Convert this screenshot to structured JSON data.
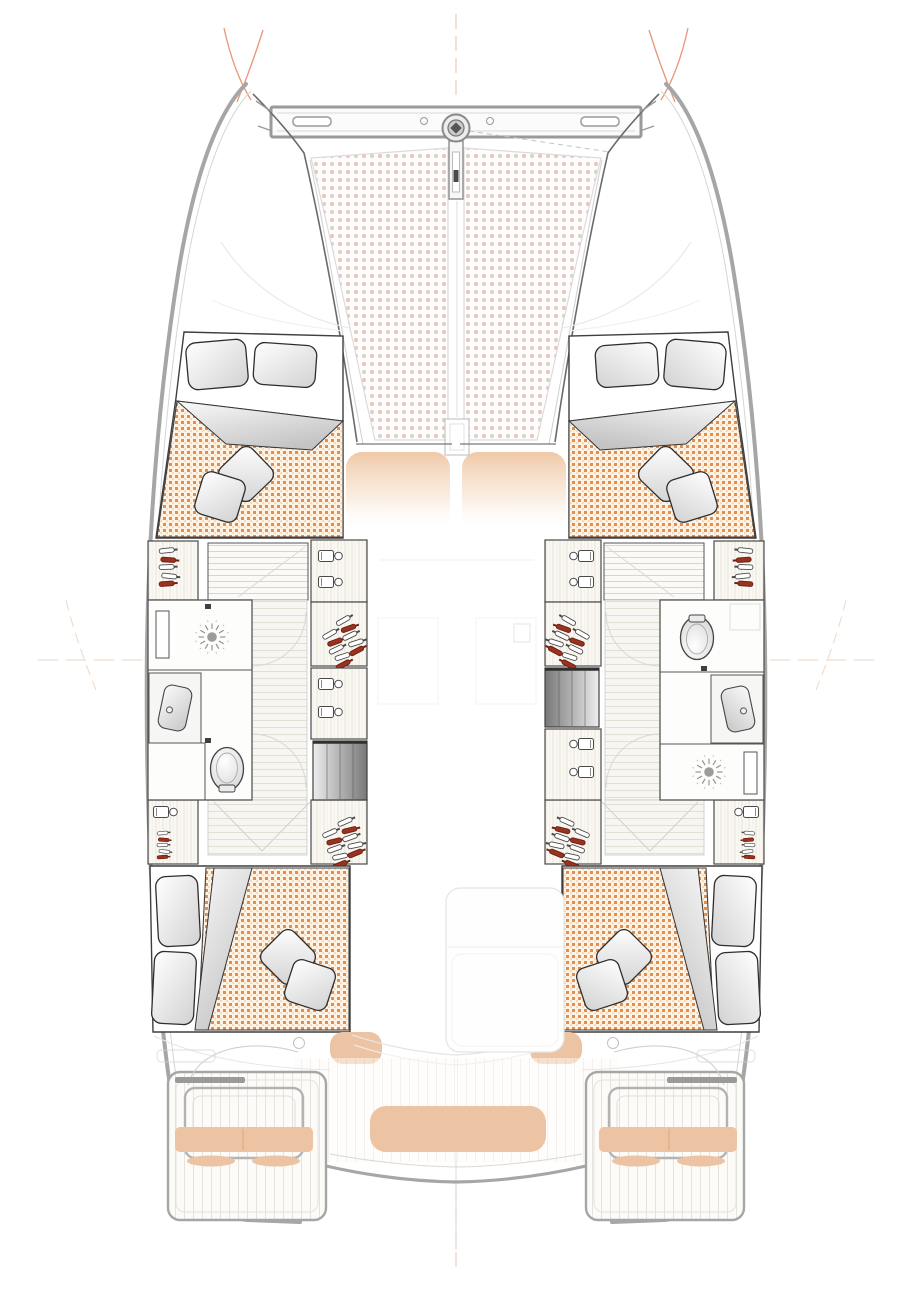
{
  "page": {
    "title": "Catamaran interior layout plan — 4 cabin / 2 head version",
    "description": "Top-down naval-architecture floor plan of a sailing catamaran: bow trampoline, forward crossbeam with bowsprit, two hulls each containing a forward double cabin, a bathroom, companionway stairs and an aft double cabin, with transom steps and cockpit benches at the stern."
  },
  "labels": {
    "port_hull": "Port hull",
    "starboard_hull": "Starboard hull",
    "trampoline": "Bow trampoline (netting)",
    "crossbeam": "Forward crossbeam",
    "bowsprit": "Bowsprit and anchor fitting",
    "forward_cabin": "Forward double cabin with berth, pillows and quilted duvet",
    "aft_cabin": "Aft double cabin with berth, pillows and quilted duvet",
    "head_port": "Port bathroom: shower, washbasin, toilet",
    "head_stbd": "Starboard bathroom: toilet, washbasin, shower",
    "stairs": "Companionway steps down from saloon",
    "wardrobe": "Hanging locker (wardrobe)",
    "shelves": "Storage shelves with bottles",
    "corridor": "Hull corridor with plank flooring",
    "saloon": "Saloon seats (deck above, faded)",
    "mast": "Mast step",
    "cockpit_table": "Cockpit furniture (deck above, faded)",
    "aft_bench": "Aft cockpit bench cushion",
    "helm_seat": "Helm / transom seat cushion",
    "transom": "Transom steps and swim platform",
    "reference_lines": "Rigging and centreline reference marks"
  },
  "counts": {
    "cabins": 4,
    "bathrooms": 2,
    "double_berths": 4,
    "trampoline_panels": 2,
    "companionways": 2,
    "transom_platforms": 2
  },
  "colors": {
    "hull-line": "#a6a6a6",
    "hull-line-soft": "#d5d5d5",
    "dark-line": "#3f3f3f",
    "wall-line": "#555555",
    "duvet-bg": "#fdf3e5",
    "duvet-dot": "#df833f",
    "duvet-dot2": "#f0b384",
    "tramp-pink": "#eac4bf",
    "tramp-gray": "#d6d2ce",
    "tan": "#edc4a3",
    "tan-dark": "#d9a87e",
    "rig": "#e89577",
    "rig-soft": "#eecab2",
    "red-bottle": "#99321f",
    "wood-bg": "#faf8f3",
    "wood-line": "#e9e5da",
    "floor-bg": "#f8f6f1",
    "floor-line": "#e3dfd4"
  }
}
